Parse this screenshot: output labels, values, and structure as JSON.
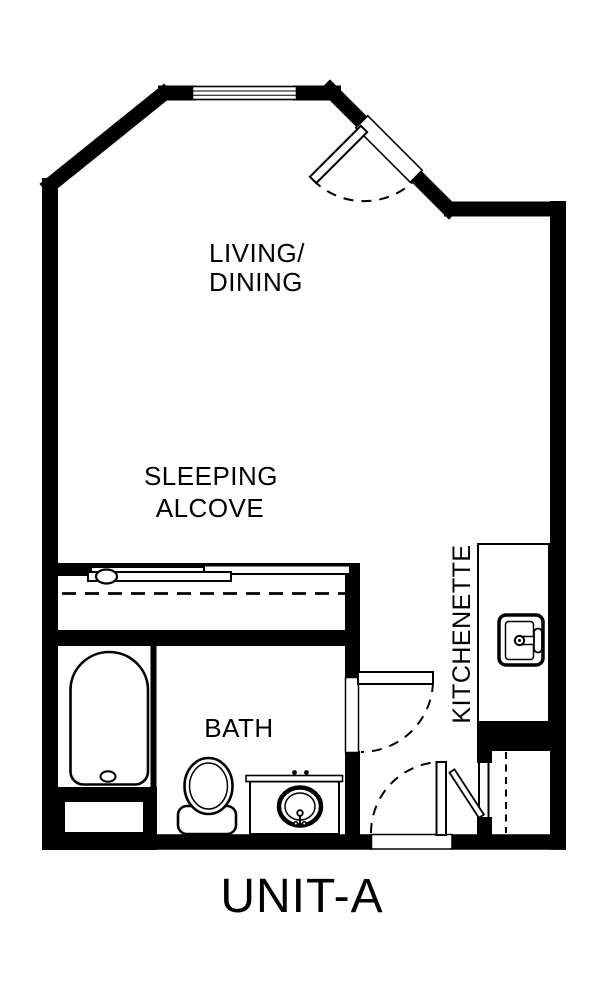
{
  "colors": {
    "ink": "#000000",
    "paper": "#ffffff"
  },
  "plan": {
    "unit_label": "UNIT-A",
    "rooms": {
      "living_dining": {
        "line1": "LIVING/",
        "line2": "DINING"
      },
      "sleeping_alcove": {
        "line1": "SLEEPING",
        "line2": "ALCOVE"
      },
      "bath": {
        "label": "BATH"
      },
      "kitchenette": {
        "label": "KITCHENETTE"
      }
    },
    "fixtures": [
      "bathtub",
      "toilet",
      "vanity-sink",
      "kitchen-sink",
      "closet-rod",
      "sliding-closet-doors",
      "window"
    ],
    "doors": [
      "living-room-door",
      "bath-door",
      "unit-entry-door",
      "entry-closet-door"
    ]
  }
}
